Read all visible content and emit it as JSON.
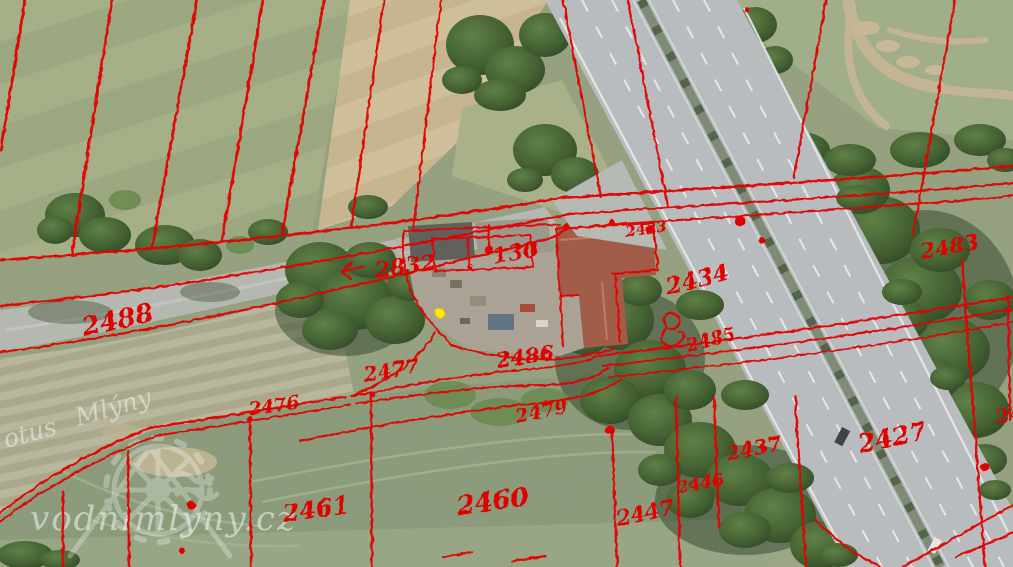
{
  "watermark": {
    "site_text": "vodnimlyny.cz",
    "fragment_left": "otus",
    "fragment_right": "Mlýny"
  },
  "colors": {
    "cadastre_overlay_red": "#e30000",
    "survey_point_yellow": "#ffe715"
  },
  "labels": [
    {
      "text": "130"
    },
    {
      "text": "2832"
    },
    {
      "text": "s"
    },
    {
      "text": "2488"
    },
    {
      "text": "2476"
    },
    {
      "text": "2477"
    },
    {
      "text": "2486"
    },
    {
      "text": "2479"
    },
    {
      "text": "2434"
    },
    {
      "text": "2485"
    },
    {
      "text": "2483"
    },
    {
      "text": "2433"
    },
    {
      "text": "2427"
    },
    {
      "text": "2437"
    },
    {
      "text": "2446"
    },
    {
      "text": "2447"
    },
    {
      "text": "2460"
    },
    {
      "text": "2461"
    },
    {
      "text": "24"
    }
  ]
}
